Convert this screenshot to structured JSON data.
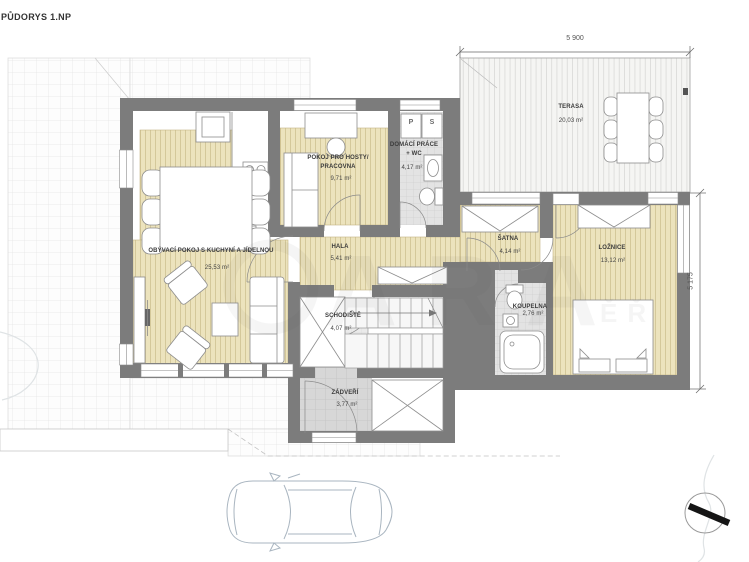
{
  "title": "PŮDORYS 1.NP",
  "rooms": [
    {
      "name": "OBÝVACÍ POKOJ S KUCHYNÍ A JÍDELNOU",
      "area": "25,53 m²"
    },
    {
      "name": "POKOJ PRO HOSTY/",
      "name2": "PRACOVNA",
      "area": "9,71 m²"
    },
    {
      "name": "DOMÁCÍ PRÁCE",
      "name2": "+ WC",
      "area": "4,17 m²"
    },
    {
      "name": "HALA",
      "area": "5,41 m²"
    },
    {
      "name": "ŠATNA",
      "area": "4,14 m²"
    },
    {
      "name": "LOŽNICE",
      "area": "13,12 m²"
    },
    {
      "name": "KOUPELNA",
      "area": "2,76 m²"
    },
    {
      "name": "SCHODIŠTĚ",
      "area": "4,07 m²"
    },
    {
      "name": "ZÁDVEŘÍ",
      "area": "3,77 m²"
    },
    {
      "name": "TERASA",
      "area": "20,03 m²"
    }
  ],
  "appliances": {
    "washer": "P",
    "dryer": "S"
  },
  "dimensions": {
    "terrace_width": "5 900",
    "right_height": "5 175"
  },
  "watermark": {
    "large": "ARA",
    "small": "ĚŘ"
  },
  "colors": {
    "wall": "#7c7c7c",
    "wood_floor": "#ece3bd",
    "deck": "#f5f5f3",
    "tile": "#d7d7d7",
    "paving_line": "#e6e6e6",
    "car_line": "#a9b5c0"
  }
}
